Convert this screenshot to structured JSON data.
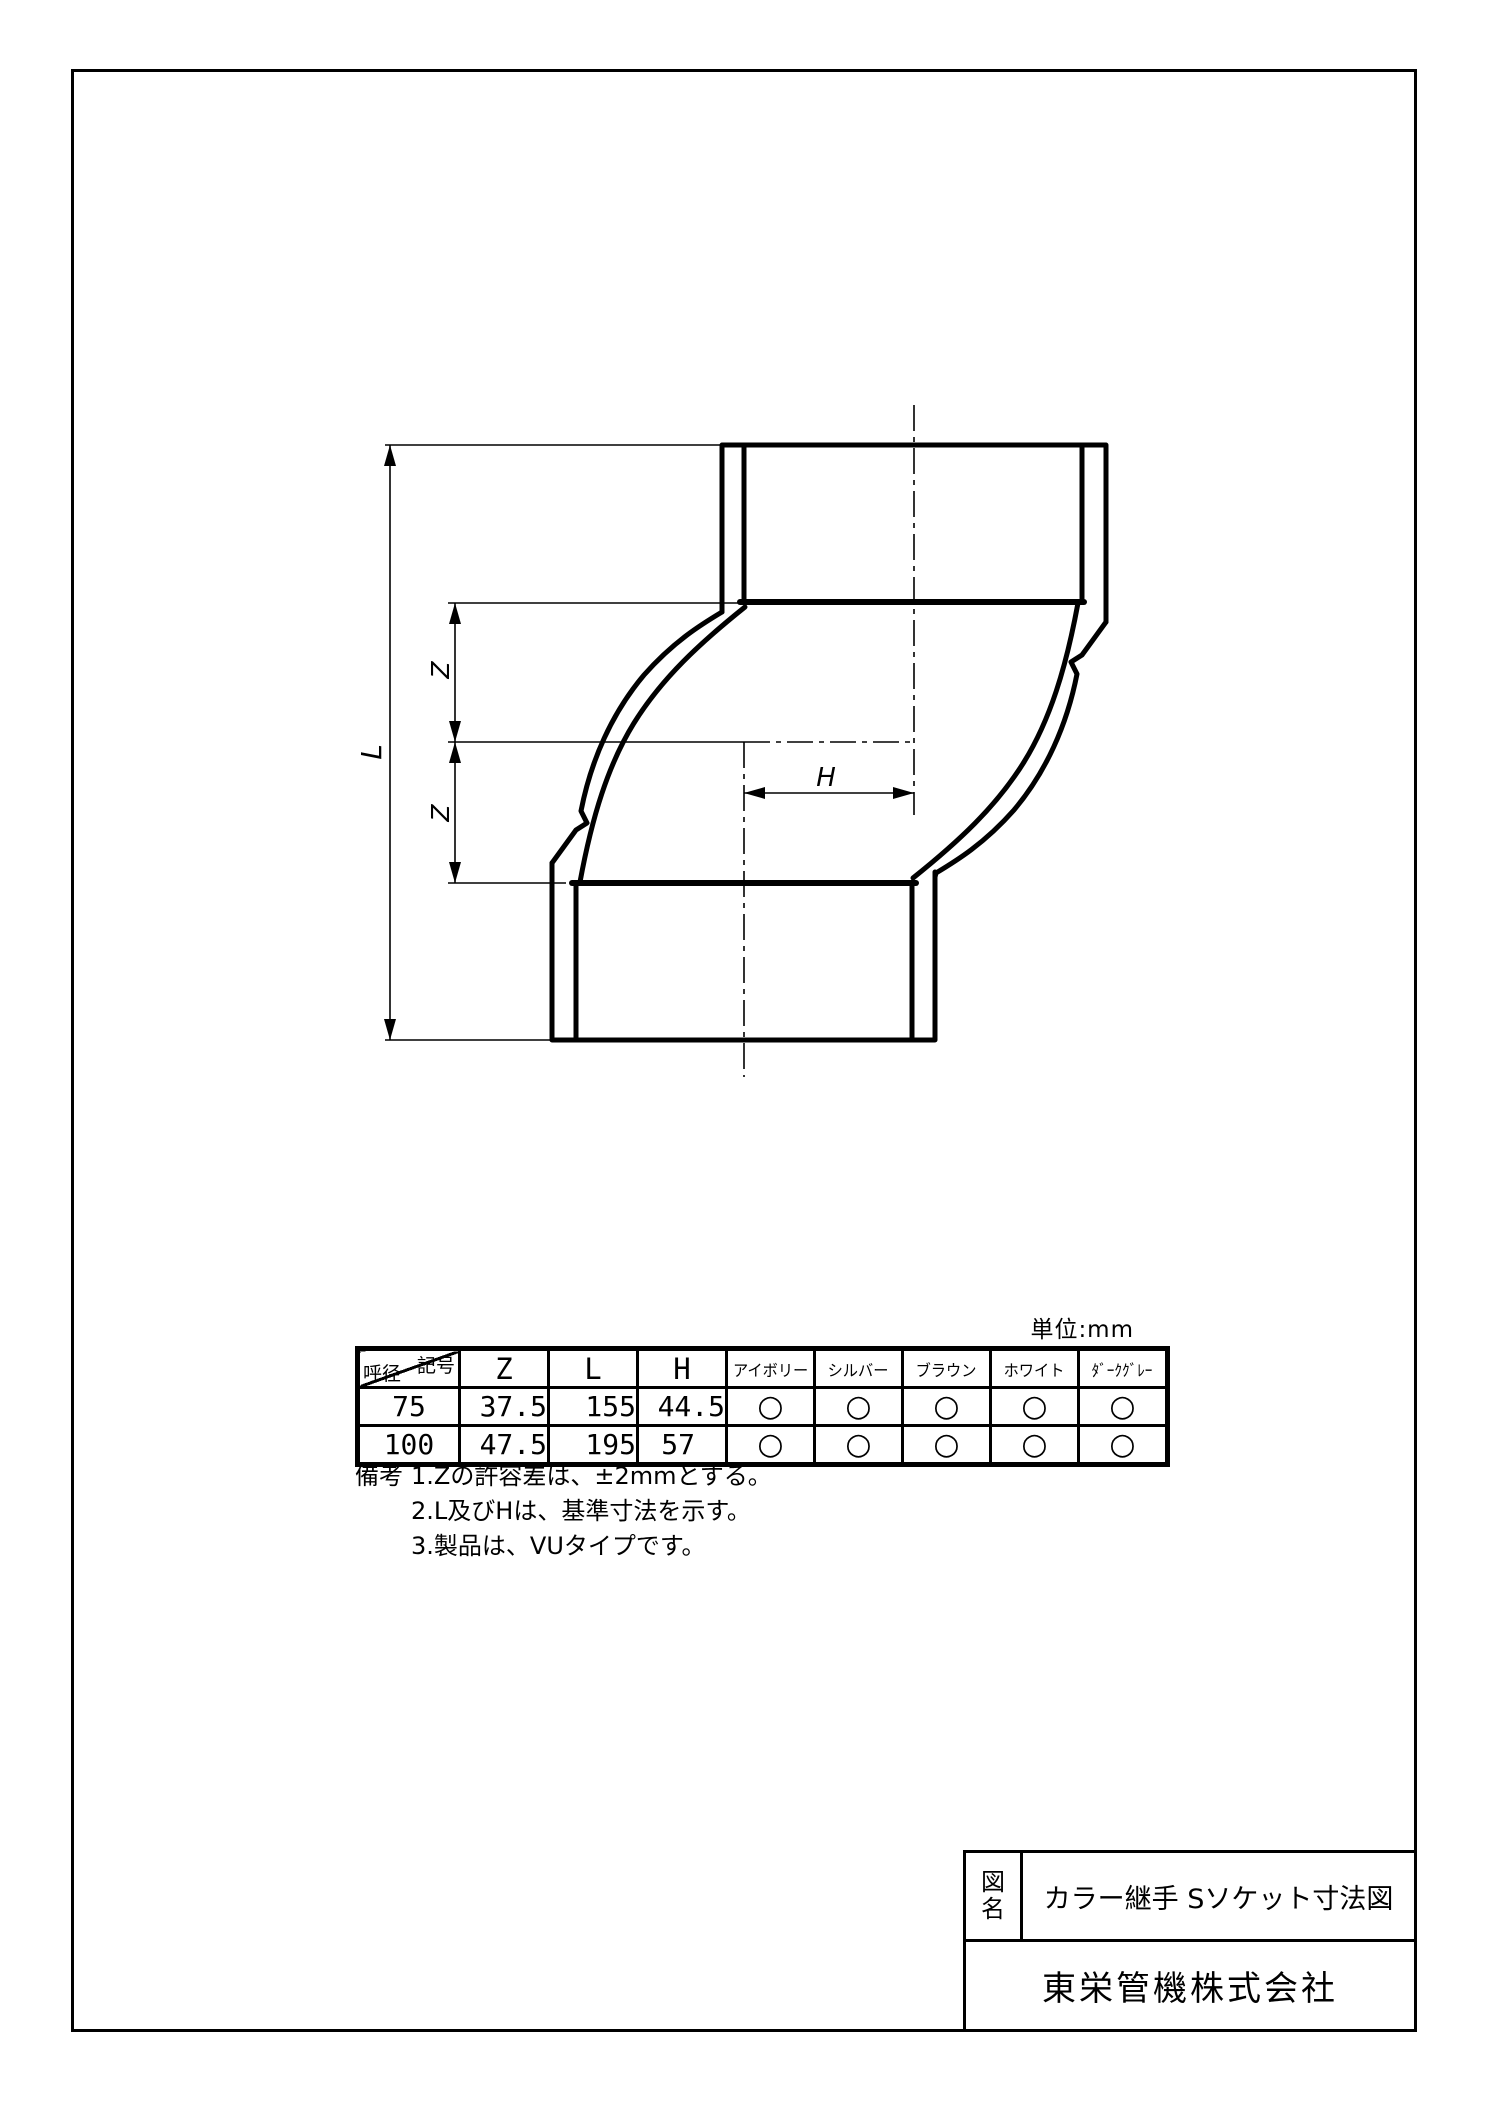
{
  "page": {
    "unit_label": "単位:mm"
  },
  "drawing": {
    "dim_l": "L",
    "dim_z_upper": "Z",
    "dim_z_lower": "Z",
    "dim_h": "H"
  },
  "table": {
    "corner_top_right": "記号",
    "corner_bottom_left": "呼径",
    "dim_headers": [
      "Z",
      "L",
      "H"
    ],
    "color_headers": [
      "アイボリー",
      "シルバー",
      "ブラウン",
      "ホワイト",
      "ﾀﾞｰｸｸﾞﾚｰ"
    ],
    "rows": [
      {
        "dia": "75",
        "z": "37.5",
        "l": "155",
        "h": "44.5",
        "marks": [
          "○",
          "○",
          "○",
          "○",
          "○"
        ]
      },
      {
        "dia": "100",
        "z": "47.5",
        "l": "195",
        "h": "57",
        "marks": [
          "○",
          "○",
          "○",
          "○",
          "○"
        ]
      }
    ]
  },
  "notes": {
    "heading": "備考",
    "items": [
      "1.Zの許容差は、±2mmとする。",
      "2.L及びHは、基準寸法を示す。",
      "3.製品は、VUタイプです。"
    ]
  },
  "title_block": {
    "label_top": "図",
    "label_bottom": "名",
    "title": "カラー継手 Sソケット寸法図",
    "company": "東栄管機株式会社"
  },
  "colors": {
    "line": "#000000",
    "background": "#ffffff"
  }
}
